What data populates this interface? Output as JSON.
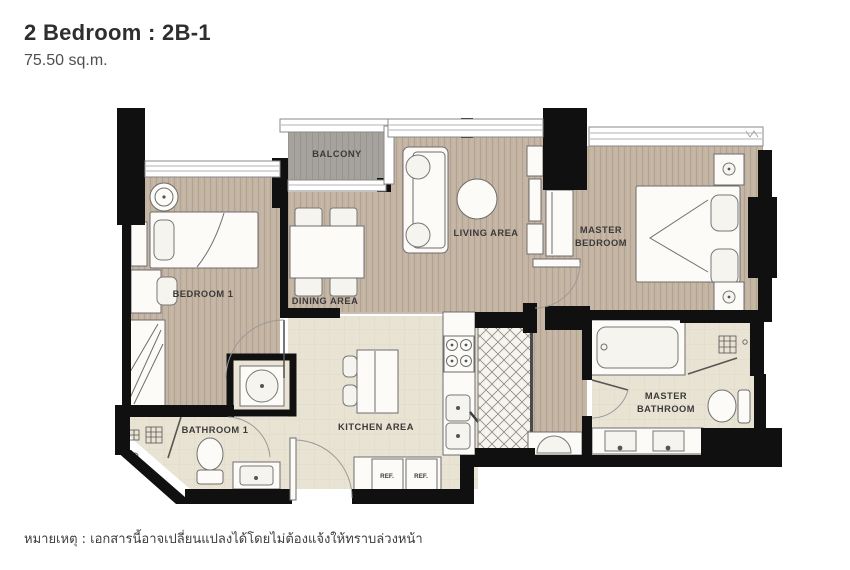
{
  "header": {
    "title": "2 Bedroom : 2B-1",
    "subtitle": "75.50 sq.m."
  },
  "footer": {
    "note": "หมายเหตุ : เอกสารนี้อาจเปลี่ยนแปลงได้โดยไม่ต้องแจ้งให้ทราบล่วงหน้า"
  },
  "labels": {
    "balcony": "BALCONY",
    "living": "LIVING AREA",
    "dining": "DINING AREA",
    "bedroom1": "BEDROOM 1",
    "master_bedroom_line1": "MASTER",
    "master_bedroom_line2": "BEDROOM",
    "bathroom1": "BATHROOM 1",
    "kitchen": "KITCHEN AREA",
    "master_bathroom_line1": "MASTER",
    "master_bathroom_line2": "BATHROOM",
    "fridge": "REF."
  },
  "colors": {
    "wall": "#101010",
    "wood_floor": "#c2b3a2",
    "tile_floor": "#e9e3d4",
    "balcony_floor": "#a6a29d"
  }
}
